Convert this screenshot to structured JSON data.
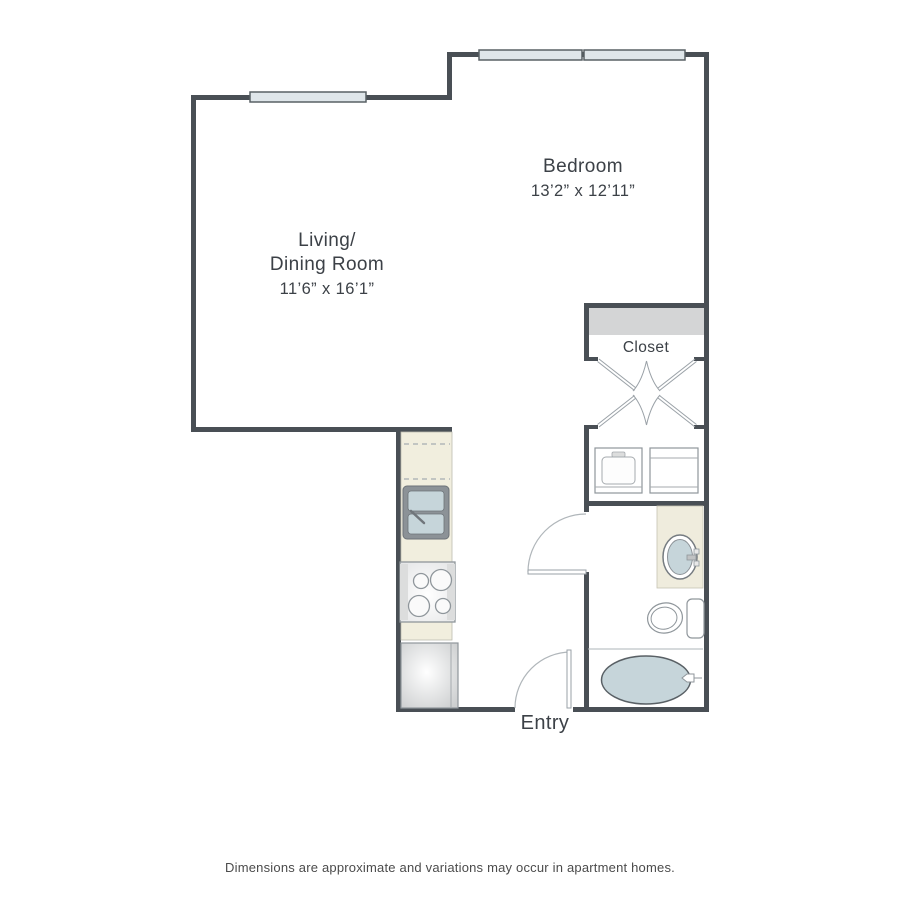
{
  "floorplan": {
    "rooms": {
      "bedroom": {
        "label": "Bedroom",
        "dimensions": "13’2” x 12’11”"
      },
      "living_dining": {
        "label_line1": "Living/",
        "label_line2": "Dining Room",
        "dimensions": "11’6” x 16’1”"
      },
      "closet": {
        "label": "Closet"
      },
      "entry": {
        "label": "Entry"
      }
    },
    "fixtures": [
      "window-icon",
      "closet-shelf",
      "bifold-doors-icon",
      "washer-icon",
      "dryer-icon",
      "kitchen-counter",
      "upper-cabinets-dashed",
      "kitchen-sink-icon",
      "stove-icon",
      "refrigerator-icon",
      "vanity-counter",
      "bathroom-sink-icon",
      "toilet-icon",
      "bathtub-icon",
      "entry-door-icon",
      "bathroom-door-icon"
    ],
    "colors": {
      "wall": "#494f55",
      "window_fill": "#dfe6ea",
      "counter_cream": "#f1eede",
      "fixture_blue": "#c6d5da",
      "shelf_gray": "#d4d5d6",
      "door_arc": "#b0b6ba",
      "text": "#3c4147"
    }
  },
  "footer": {
    "disclaimer": "Dimensions are approximate and variations may occur in apartment homes."
  }
}
